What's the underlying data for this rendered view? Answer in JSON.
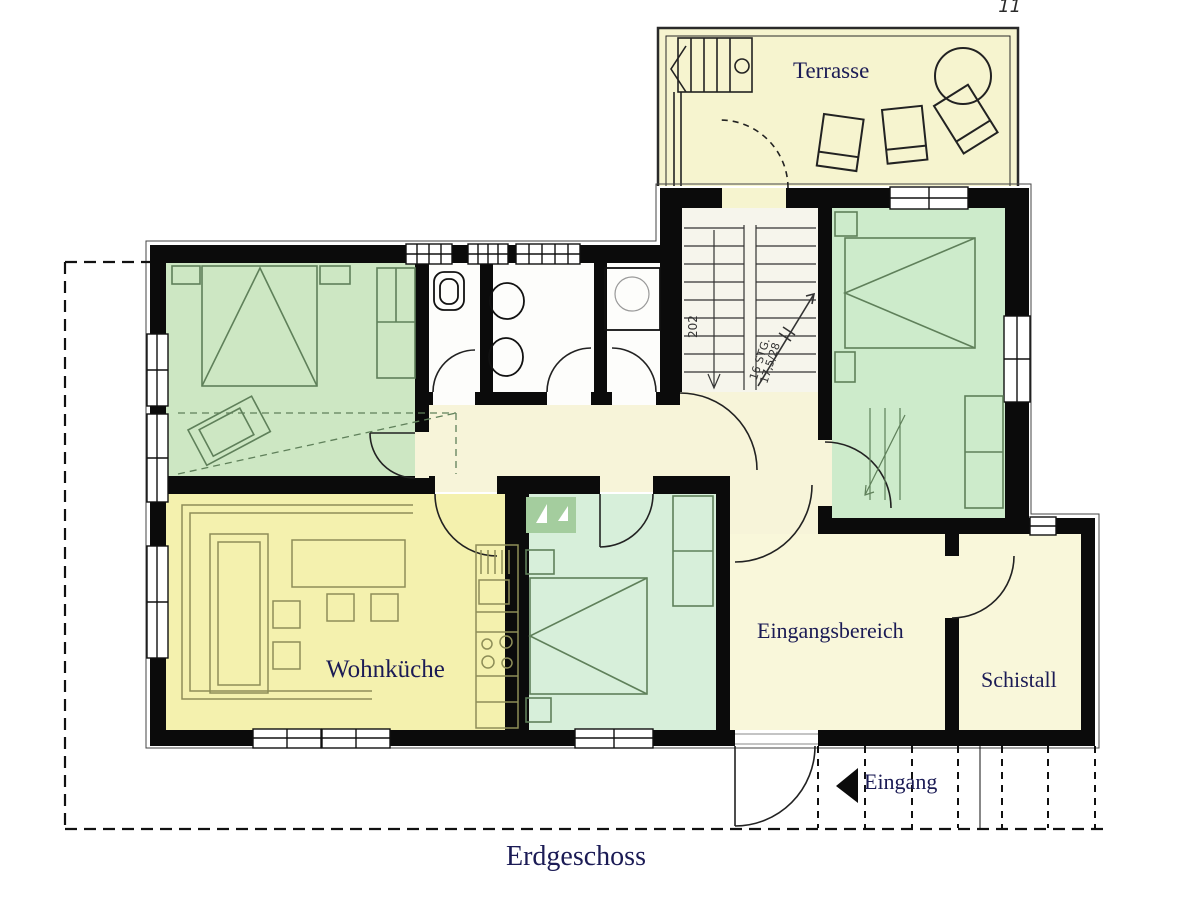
{
  "plan": {
    "caption": "Erdgeschoss",
    "corner_mark": "11",
    "colors": {
      "wall_black": "#0b0b0b",
      "bedroom_green": "#cde7c3",
      "bedroom_green_light": "#d7efda",
      "kitchen_yellow": "#f4f1ae",
      "floor_cream": "#f7f4d9",
      "terrace_cream": "#f6f4cf",
      "label_navy": "#1b1b55"
    }
  },
  "rooms": {
    "terrasse": {
      "label": "Terrasse"
    },
    "wohnkueche": {
      "label": "Wohnküche"
    },
    "eingangsbereich": {
      "label": "Eingangsbereich"
    },
    "schistall": {
      "label": "Schistall"
    },
    "eingang": {
      "label": "Eingang"
    }
  },
  "stairs": {
    "room_number": "202",
    "steps_note": "16 STG.",
    "riser_note": "17,5/28"
  }
}
